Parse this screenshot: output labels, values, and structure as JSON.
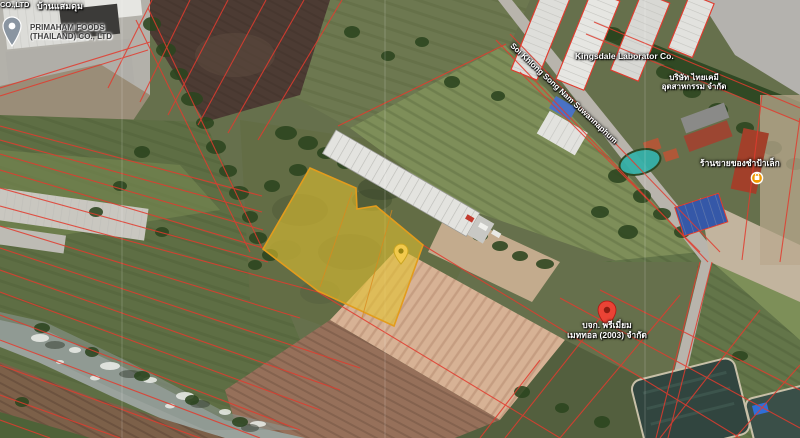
{
  "labels": {
    "corner_company_fragment": "CO.,LTD",
    "village": "บ้านแสมดุม",
    "factory": {
      "line1": "PRIMAHAM FOODS",
      "line2": "(THAILAND) CO., LTD"
    },
    "road": "Soi Khlong Song Nam Suwannaphum",
    "company_kingsdale": "Kingsdale Laborator Co.",
    "company_right": {
      "line1": "บริษัท ไทยเคมี",
      "line2": "อุตสาหกรรม จำกัด"
    },
    "shop": "ร้านขายของชำป้าเล็ก",
    "red_pin": {
      "line1": "บจก. พรีเมี่ยม",
      "line2": "เมททอล (2003) จำกัด"
    }
  },
  "markers": {
    "red_pin": "red-destination-pin",
    "yellow_pin": "selected-parcel-pin",
    "gray_pin": "business-place-pin",
    "shop_poi": "shopping-poi-dot"
  },
  "colors": {
    "cadastral_line": "#e23b2e",
    "parcel_fill": "#e3c22e",
    "parcel_border": "#e39c1c",
    "red_pin": "#ea4335",
    "yellow_pin": "#f2c94c",
    "poi_orange": "#f29900",
    "water_teal": "#35b0a8"
  }
}
